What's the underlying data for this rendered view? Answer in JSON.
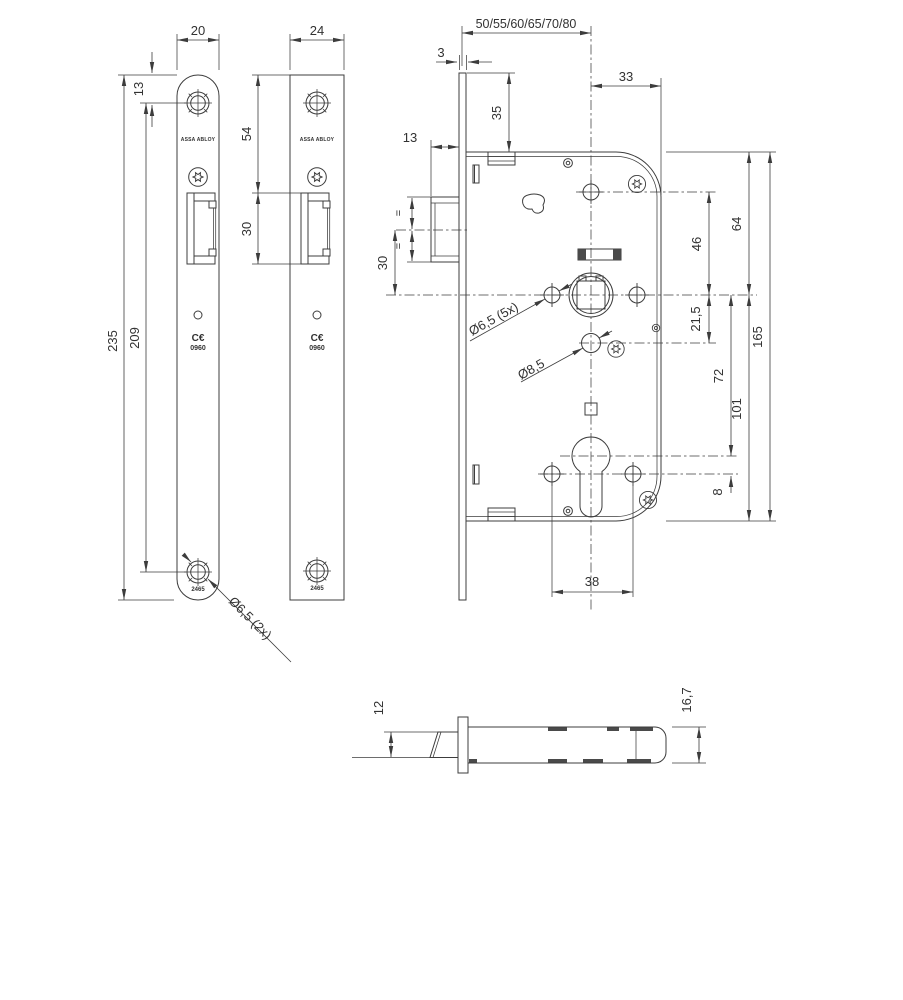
{
  "brand": "ASSA ABLOY",
  "product_code": "2465",
  "ce": {
    "mark": "C€",
    "number": "0960"
  },
  "dims": {
    "plate1_width": "20",
    "plate2_width": "24",
    "plate_top_to_hole": "13",
    "plate_length": "235",
    "plate_holes_cc": "209",
    "plate2_top_to_cutout": "54",
    "cutout_height": "30",
    "plate_holes_dia": "Ø6,5 (2x)",
    "backset_options": "50/55/60/65/70/80",
    "faceplate_thickness": "3",
    "spindle_to_case_back": "33",
    "plate_end_to_case": "35",
    "latch_projection": "13",
    "equal": "=",
    "latch_to_spindle": "30",
    "top_hole_to_spindle": "46",
    "case_top_to_spindle": "64",
    "spindle_to_aux_hole": "21,5",
    "case_height": "165",
    "spindle_to_cylinder": "72",
    "spindle_to_case_bottom": "101",
    "cylinder_to_fix_holes": "8",
    "fix_holes_cc": "38",
    "case_holes_dia": "Ø6,5 (5x)",
    "aux_hole_dia": "Ø8,5",
    "latch_width": "12",
    "case_thickness": "16,7"
  }
}
